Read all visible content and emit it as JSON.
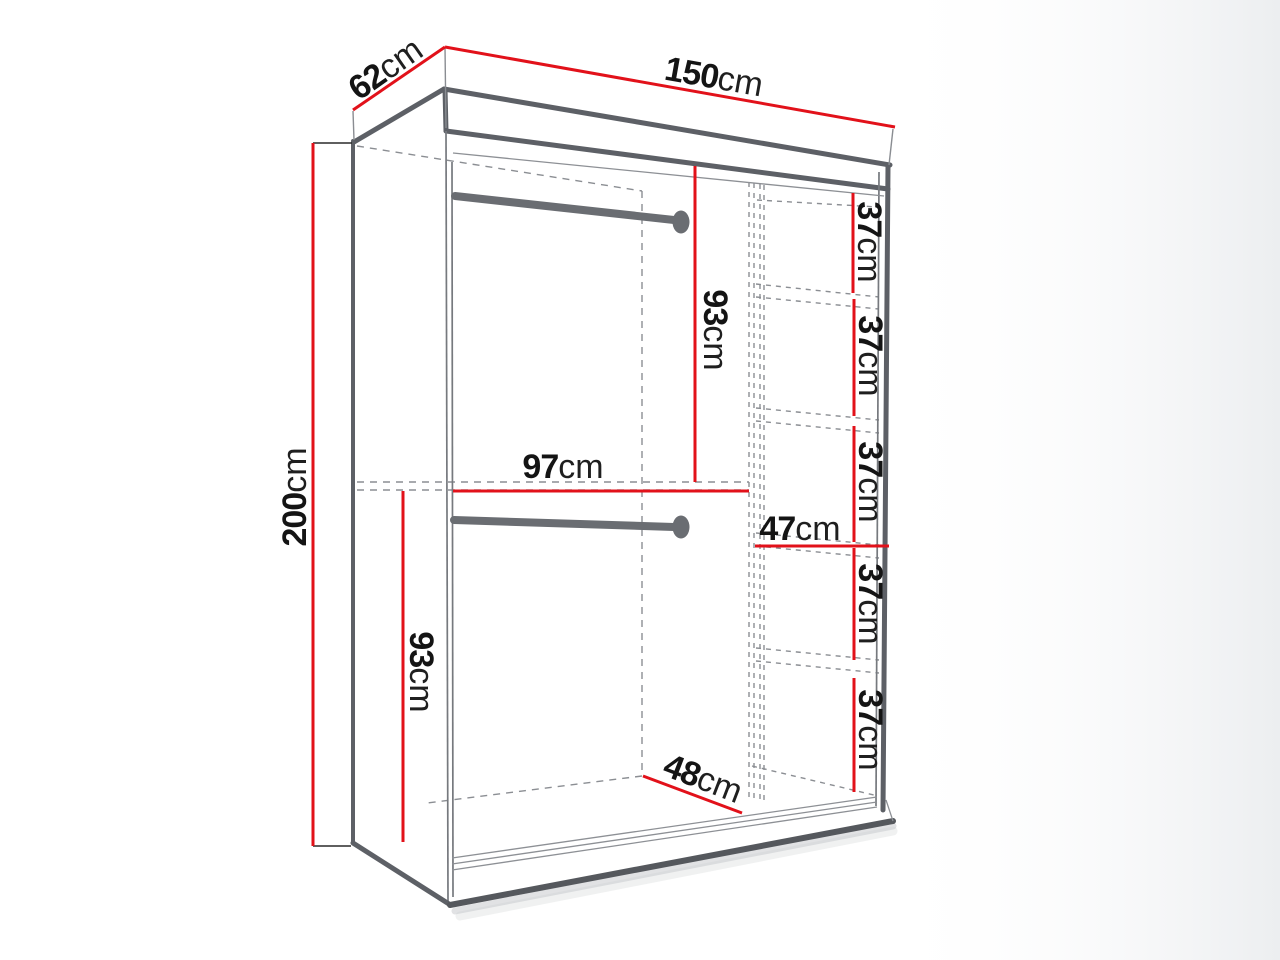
{
  "title": "Wardrobe dimension diagram",
  "unit": "cm",
  "colors": {
    "dimension_line": "#e2111a",
    "outline": "#5d6066",
    "hidden_line": "#8b8e93",
    "text": "#141414",
    "background": "#ffffff"
  },
  "labels": {
    "width": {
      "num": "150",
      "unit": "cm"
    },
    "depth": {
      "num": "62",
      "unit": "cm"
    },
    "height": {
      "num": "200",
      "unit": "cm"
    },
    "upper_section_height": {
      "num": "93",
      "unit": "cm"
    },
    "lower_section_height": {
      "num": "93",
      "unit": "cm"
    },
    "hanging_section_width": {
      "num": "97",
      "unit": "cm"
    },
    "shelf_section_width": {
      "num": "47",
      "unit": "cm"
    },
    "interior_floor_depth": {
      "num": "48",
      "unit": "cm"
    },
    "shelf_gaps": [
      {
        "num": "37",
        "unit": "cm"
      },
      {
        "num": "37",
        "unit": "cm"
      },
      {
        "num": "37",
        "unit": "cm"
      },
      {
        "num": "37",
        "unit": "cm"
      },
      {
        "num": "37",
        "unit": "cm"
      }
    ]
  }
}
